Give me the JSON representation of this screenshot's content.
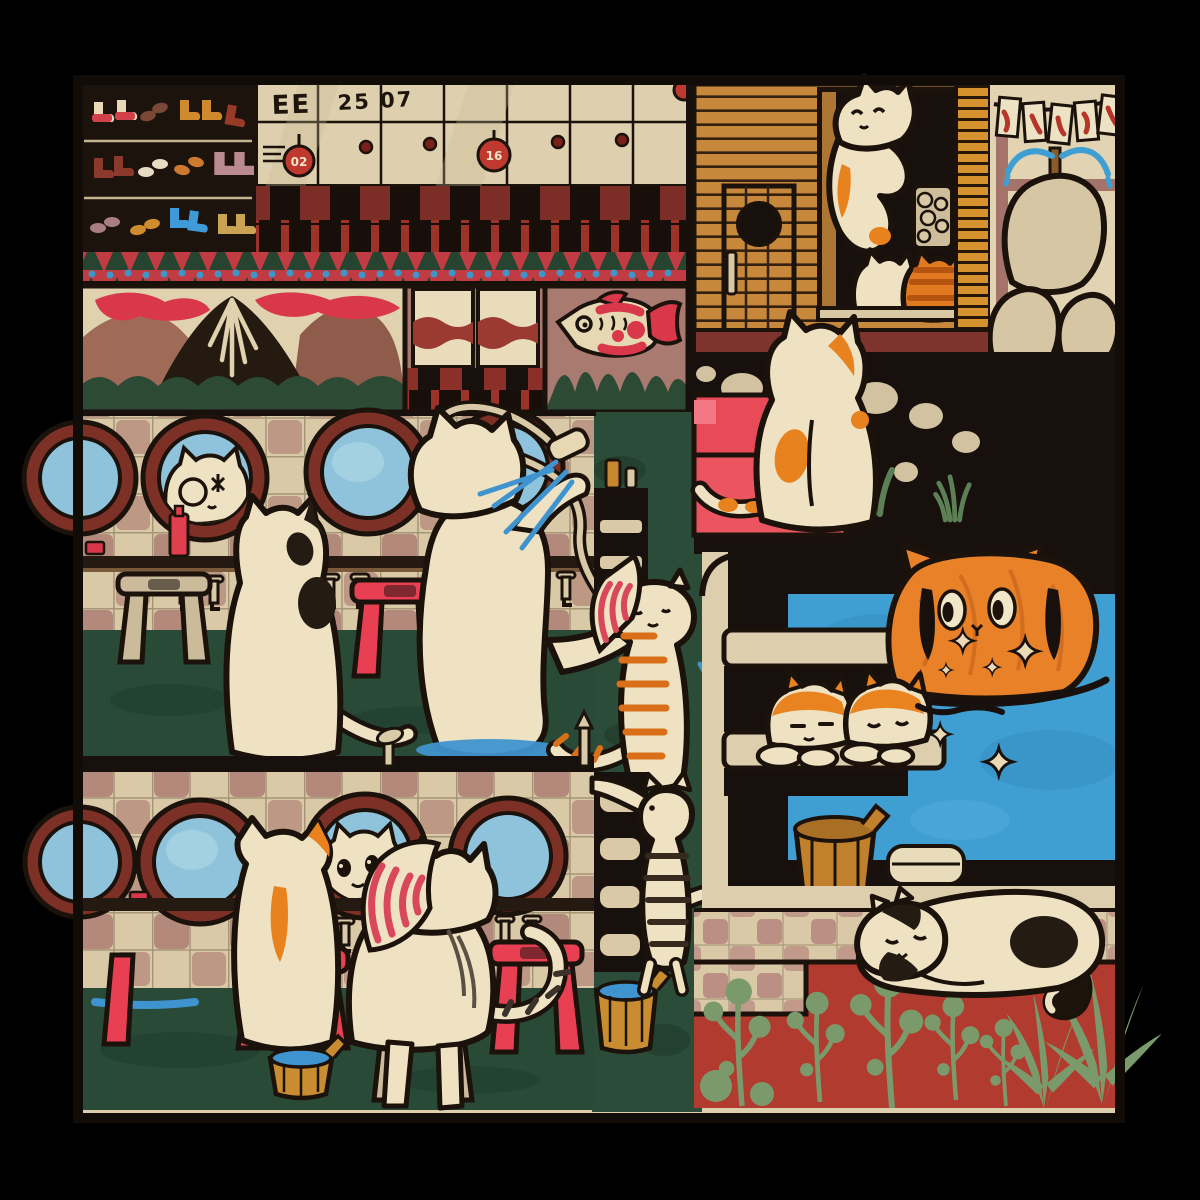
{
  "subject": "cats relaxing at a japanese public bathhouse (sento) illustration",
  "labels": {
    "locker_a": "EE",
    "locker_b": "25 07",
    "key_tag_a": "02",
    "key_tag_b": "16"
  },
  "palette": {
    "outer_background": "#000000",
    "ink_outline": "#1a120b",
    "paper_cream": "#ddcead",
    "cat_cream": "#efe2c2",
    "accent_red": "#e84a58",
    "deep_maroon": "#7c2e26",
    "wood_orange": "#c8883c",
    "tabby_orange": "#e8821f",
    "water_blue": "#3f9fd2",
    "mirror_blue": "#8fc3dc",
    "floor_green": "#2a4a38",
    "sage_green": "#7b9a6b",
    "tile_mauve": "#b2897b",
    "plant_wall_red": "#b23b30"
  }
}
